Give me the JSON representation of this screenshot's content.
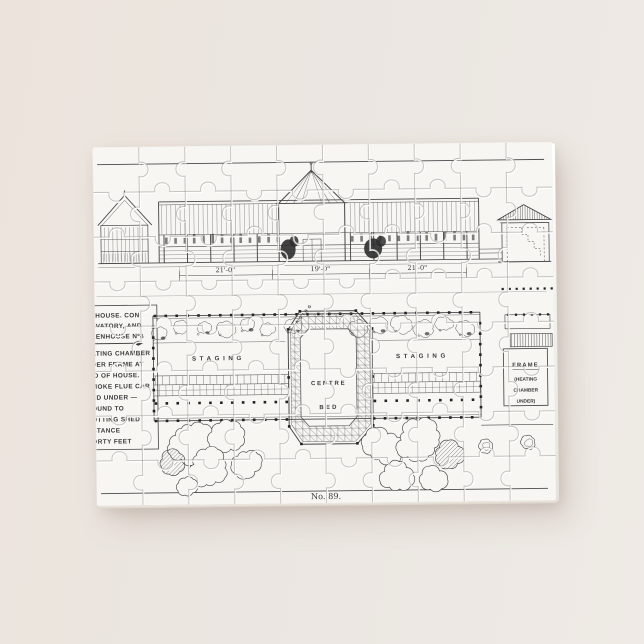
{
  "scene": {
    "background_color": "#ebe6e1",
    "paper_color": "#f7f6f3",
    "ink_color": "#3a3a3a"
  },
  "puzzle": {
    "plate_label": "No. 89.",
    "elevation": {
      "dim_left": "21'-0\"",
      "dim_mid": "19'-0\"",
      "dim_right": "21'-0\""
    },
    "plan": {
      "staging_left": "STAGING",
      "staging_right": "STAGING",
      "staging_arc": "STAGING",
      "centre_line1": "CENTRE",
      "centre_line2": "BED",
      "frame_title": "FRAME",
      "frame_sub1": "(HEATING",
      "frame_sub2": "CHAMBER",
      "frame_sub3": "UNDER)"
    },
    "note": {
      "lines": [
        "THOUSE. CON",
        "SVATORY, AND",
        "EENHOUSE Nº4",
        "ATING CHAMBER",
        "DER FRAME AT",
        "ID OF HOUSE.",
        "MOKE FLUE CAR",
        "ED UNDER —",
        "OUND TO",
        "OTTING SHED",
        "STANCE",
        "ORTY FEET"
      ]
    }
  }
}
